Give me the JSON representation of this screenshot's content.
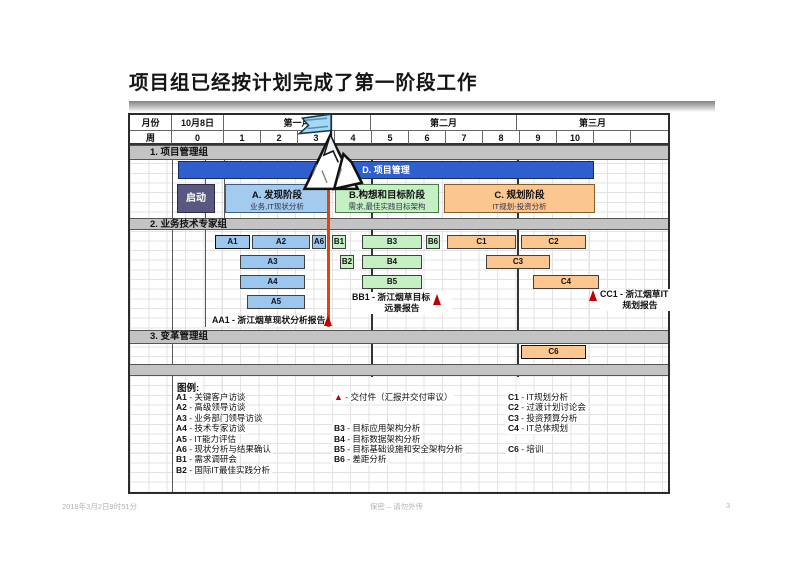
{
  "title": "项目组已经按计划完成了第一阶段工作",
  "footer": {
    "timestamp": "2018年3月2日9时51分",
    "classification": "保密 – 请勿外传",
    "page": "3"
  },
  "colors": {
    "management_bar": "#2f5fce",
    "kickoff": "#585880",
    "phase_a_blue": "#9dc6ee",
    "phase_b_green": "#c4f0c4",
    "phase_c_orange": "#fbc68f",
    "section_band_gray": "#c3c3c3",
    "progress_line_red": "#e8410c",
    "milestone_red": "#c00000"
  },
  "gantt": {
    "header": {
      "month_col": "月份",
      "week_col": "周",
      "start_date": "10月8日",
      "week0": "0",
      "months": [
        "第一月",
        "第二月",
        "第三月"
      ],
      "weeks": [
        "1",
        "2",
        "3",
        "4",
        "5",
        "6",
        "7",
        "8",
        "9",
        "10",
        "",
        ""
      ]
    },
    "sections": [
      {
        "title": "1. 项目管理组"
      },
      {
        "title": "2. 业务技术专家组"
      },
      {
        "title": "3. 变革管理组"
      }
    ],
    "management_bar": {
      "label": "D. 项目管理"
    },
    "kickoff": {
      "label": "启动"
    },
    "phases": [
      {
        "title": "A. 发现阶段",
        "subtitle": "业务,IT现状分析"
      },
      {
        "title": "B.构想和目标阶段",
        "subtitle": "需求,最佳实践目标架构"
      },
      {
        "title": "C. 规划阶段",
        "subtitle": "IT规划-投资分析"
      }
    ],
    "tasks": [
      {
        "label": "A1",
        "row": 0,
        "x": 85,
        "w": 35,
        "strong": true
      },
      {
        "label": "A2",
        "row": 0,
        "x": 122,
        "w": 58
      },
      {
        "label": "A6",
        "row": 0,
        "x": 182,
        "w": 14
      },
      {
        "label": "B1",
        "row": 0,
        "x": 202,
        "w": 14
      },
      {
        "label": "B3",
        "row": 0,
        "x": 232,
        "w": 60
      },
      {
        "label": "B6",
        "row": 0,
        "x": 296,
        "w": 14
      },
      {
        "label": "C1",
        "row": 0,
        "x": 317,
        "w": 69
      },
      {
        "label": "C2",
        "row": 0,
        "x": 391,
        "w": 65
      },
      {
        "label": "A3",
        "row": 1,
        "x": 110,
        "w": 65
      },
      {
        "label": "B2",
        "row": 1,
        "x": 210,
        "w": 14
      },
      {
        "label": "B4",
        "row": 1,
        "x": 232,
        "w": 60
      },
      {
        "label": "C3",
        "row": 1,
        "x": 356,
        "w": 64
      },
      {
        "label": "A4",
        "row": 2,
        "x": 110,
        "w": 65
      },
      {
        "label": "B5",
        "row": 2,
        "x": 232,
        "w": 60
      },
      {
        "label": "C4",
        "row": 2,
        "x": 403,
        "w": 66
      },
      {
        "label": "A5",
        "row": 3,
        "x": 117,
        "w": 58
      },
      {
        "label": "C6",
        "row": 5,
        "x": 391,
        "w": 65,
        "strong": true
      }
    ],
    "milestones": [
      {
        "id": "AA1",
        "lines": [
          "AA1 - 浙江烟草现状分析报告"
        ]
      },
      {
        "id": "BB1",
        "lines": [
          "BB1 - 浙江烟草目标",
          "远景报告"
        ]
      },
      {
        "id": "CC1",
        "lines": [
          "CC1 - 浙江烟草IT",
          "规划报告"
        ]
      }
    ],
    "legend": {
      "title": "图例:",
      "columns": [
        {
          "x": 44,
          "entries": [
            {
              "row": 0,
              "code": "A1",
              "text": "关键客户访谈"
            },
            {
              "row": 1,
              "code": "A2",
              "text": "高级领导访谈"
            },
            {
              "row": 2,
              "code": "A3",
              "text": "业务部门领导访谈"
            },
            {
              "row": 3,
              "code": "A4",
              "text": "技术专家访谈"
            },
            {
              "row": 4,
              "code": "A5",
              "text": "IT能力评估"
            },
            {
              "row": 5,
              "code": "A6",
              "text": "现状分析与结果确认"
            },
            {
              "row": 6,
              "code": "B1",
              "text": "需求调研会"
            },
            {
              "row": 7,
              "code": "B2",
              "text": "国际IT最佳实践分析"
            }
          ]
        },
        {
          "x": 202,
          "entries": [
            {
              "row": 0,
              "icon": "deliverable-triangle",
              "code": "▲",
              "text": "交付件（汇报并交付审议）"
            },
            {
              "row": 3,
              "code": "B3",
              "text": "目标应用架构分析"
            },
            {
              "row": 4,
              "code": "B4",
              "text": "目标数据架构分析"
            },
            {
              "row": 5,
              "code": "B5",
              "text": "目标基础设施和安全架构分析"
            },
            {
              "row": 6,
              "code": "B6",
              "text": "差距分析"
            }
          ]
        },
        {
          "x": 376,
          "entries": [
            {
              "row": 0,
              "code": "C1",
              "text": "IT规划分析"
            },
            {
              "row": 1,
              "code": "C2",
              "text": "过渡计划讨论会"
            },
            {
              "row": 2,
              "code": "C3",
              "text": "投资预算分析"
            },
            {
              "row": 3,
              "code": "C4",
              "text": "IT总体规划"
            },
            {
              "row": 5,
              "code": "C6",
              "text": "培训"
            }
          ]
        }
      ]
    }
  }
}
